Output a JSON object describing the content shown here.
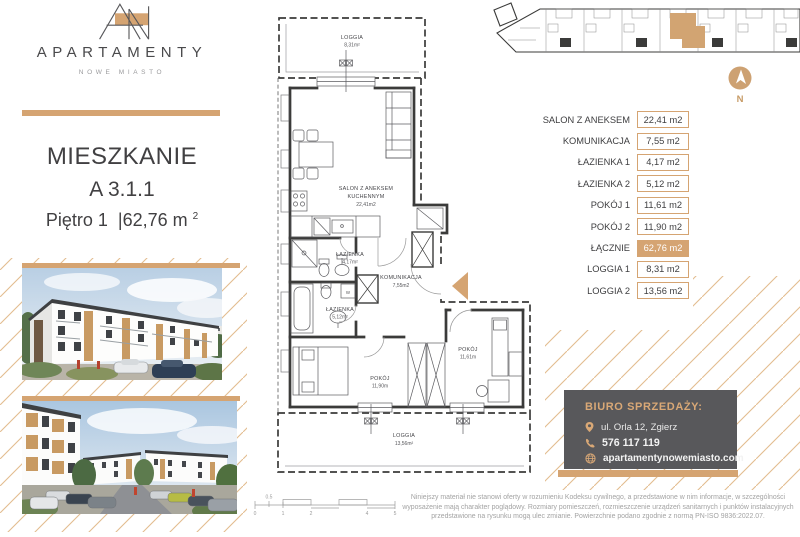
{
  "brand": {
    "name": "APARTAMENTY",
    "tagline": "NOWE MIASTO"
  },
  "listing": {
    "title": "MIESZKANIE",
    "unit": "A 3.1.1",
    "floor_label": "Piętro 1",
    "separator": "|",
    "area_value": "62,76 m",
    "area_exponent": "2"
  },
  "floor_plan": {
    "loggia1": {
      "name": "LOGGIA",
      "area": "8,31m²"
    },
    "salon": {
      "name1": "SALON Z ANEKSEM",
      "name2": "KUCHENNYM",
      "area": "22,41m2"
    },
    "bathroom1": {
      "name": "ŁAZIENKA",
      "area": "4,17m²"
    },
    "bathroom2": {
      "name": "ŁAZIENKA",
      "area": "5,12m²"
    },
    "hall": {
      "name": "KOMUNIKACJA",
      "area": "7,55m2"
    },
    "room2": {
      "name": "POKÓJ",
      "area": "11,90m"
    },
    "room1": {
      "name": "POKÓJ",
      "area": "11,61m"
    },
    "loggia2": {
      "name": "LOGGIA",
      "area": "13,56m²"
    },
    "washer_label": "W"
  },
  "areas_table": {
    "rows": [
      {
        "label": "SALON Z ANEKSEM",
        "value": "22,41 m2"
      },
      {
        "label": "KOMUNIKACJA",
        "value": "7,55 m2"
      },
      {
        "label": "ŁAZIENKA 1",
        "value": "4,17 m2"
      },
      {
        "label": "ŁAZIENKA 2",
        "value": "5,12 m2"
      },
      {
        "label": "POKÓJ 1",
        "value": "11,61 m2"
      },
      {
        "label": "POKÓJ 2",
        "value": "11,90 m2"
      },
      {
        "label": "ŁĄCZNIE",
        "value": "62,76 m2"
      },
      {
        "label": "LOGGIA 1",
        "value": "8,31 m2"
      },
      {
        "label": "LOGGIA 2",
        "value": "13,56 m2"
      }
    ]
  },
  "compass": {
    "label": "N"
  },
  "sales_office": {
    "title": "BIURO SPRZEDAŻY:",
    "address": "ul. Orla 12, Zgierz",
    "phone": "576 117 119",
    "website": "apartamentynowemiasto.com"
  },
  "disclaimer": "Niniejszy materiał nie stanowi oferty w rozumieniu Kodeksu cywilnego, a przedstawione w nim informacje, w szczególności wyposażenie mają charakter poglądowy. Rozmiary pomieszczeń, rozmieszczenie urządzeń sanitarnych i punktów instalacyjnych przedstawione na rysunku mogą ulec zmianie. Powierzchnie podano zgodnie z normą PN-ISO 9836:2022.07.",
  "scale_bar": {
    "labels": [
      "0",
      "0.5",
      "1",
      "2",
      "4",
      "5"
    ]
  },
  "colors": {
    "gold": "#D5A472",
    "gold_light": "#E3BD8F",
    "dark_gray": "#58585B",
    "text_dark": "#414042",
    "plan_line": "#3B3B3A"
  }
}
